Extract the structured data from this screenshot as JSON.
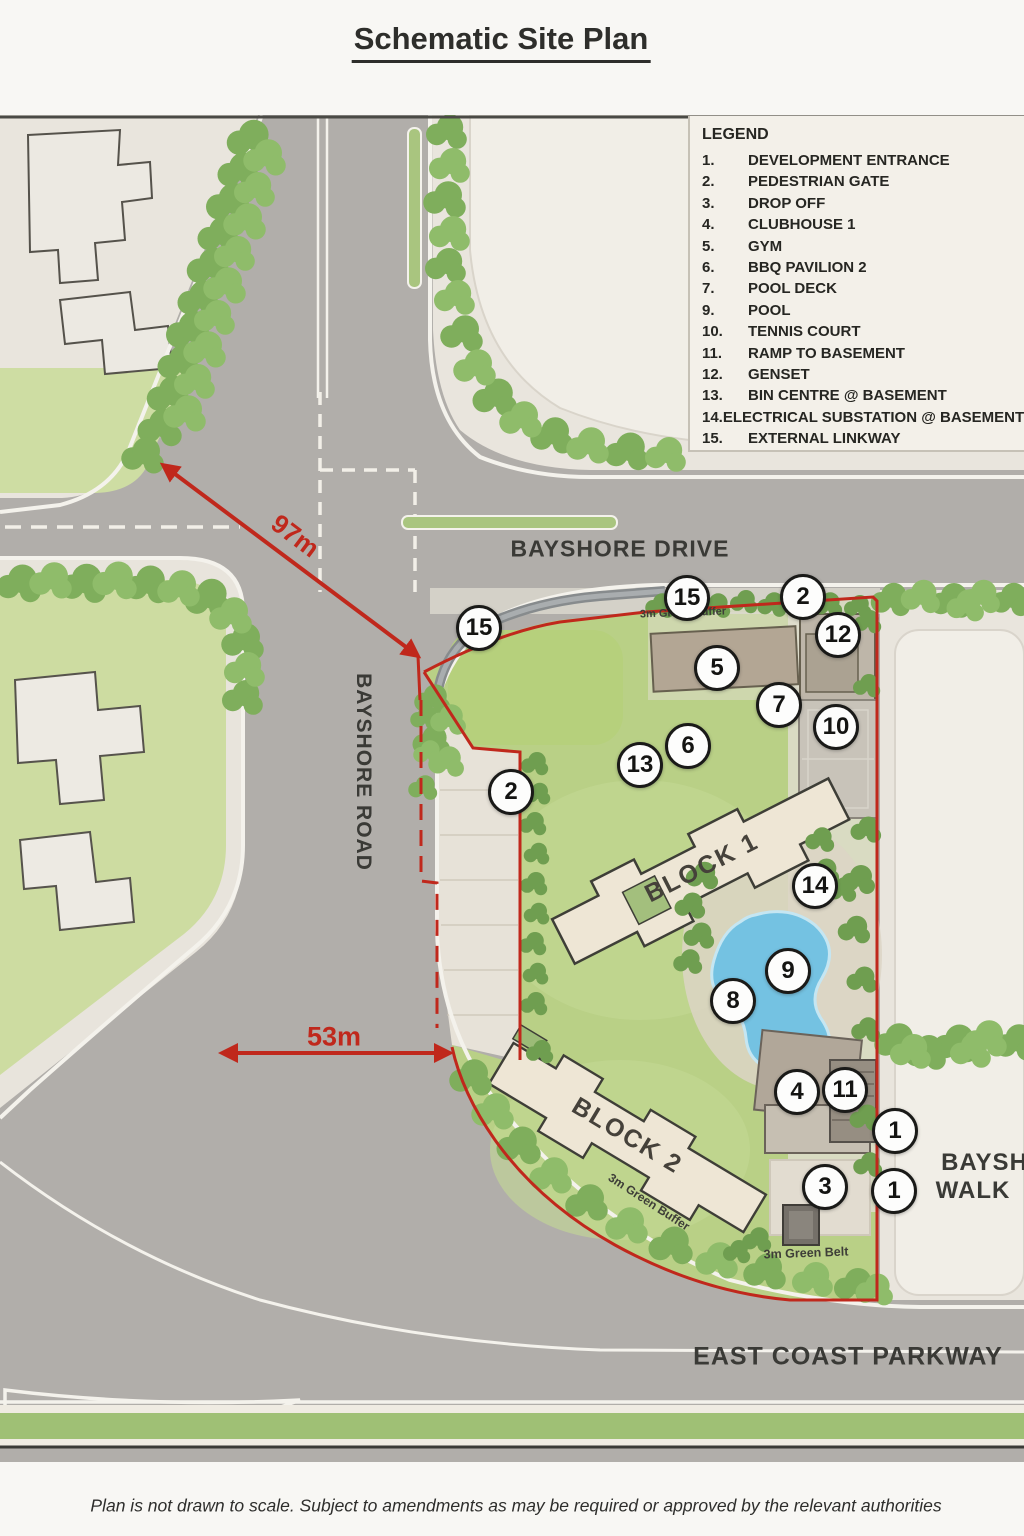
{
  "page": {
    "title": "Schematic Site Plan",
    "footer": "Plan is not drawn to scale. Subject to amendments as may be required or approved by the relevant authorities"
  },
  "legend": {
    "title": "LEGEND",
    "items": [
      {
        "num": "1.",
        "label": "DEVELOPMENT ENTRANCE"
      },
      {
        "num": "2.",
        "label": "PEDESTRIAN GATE"
      },
      {
        "num": "3.",
        "label": "DROP OFF"
      },
      {
        "num": "4.",
        "label": "CLUBHOUSE 1"
      },
      {
        "num": "5.",
        "label": "GYM"
      },
      {
        "num": "6.",
        "label": "BBQ PAVILION 2"
      },
      {
        "num": "7.",
        "label": "POOL DECK"
      },
      {
        "num": "9.",
        "label": "POOL"
      },
      {
        "num": "10.",
        "label": "TENNIS COURT"
      },
      {
        "num": "11.",
        "label": "RAMP TO BASEMENT"
      },
      {
        "num": "12.",
        "label": "GENSET"
      },
      {
        "num": "13.",
        "label": "BIN CENTRE @ BASEMENT"
      },
      {
        "num": "14.",
        "label": "ELECTRICAL SUBSTATION @ BASEMENT"
      },
      {
        "num": "15.",
        "label": "EXTERNAL LINKWAY"
      }
    ]
  },
  "roads": {
    "bayshore_drive": "BAYSHORE DRIVE",
    "bayshore_road": "BAYSHORE ROAD",
    "east_coast_parkway": "EAST COAST PARKWAY",
    "bayshore_walk_line1": "BAYSHORE",
    "bayshore_walk_line2": "WALK"
  },
  "site": {
    "block1": "BLOCK 1",
    "block2": "BLOCK 2"
  },
  "dimensions": {
    "d97": "97m",
    "d53": "53m"
  },
  "map_labels": {
    "buffers": [
      {
        "text": "3m Green Buffer",
        "x": 683,
        "y": 613,
        "rot": -2,
        "size": 11
      },
      {
        "text": "3m Green Buffer",
        "x": 649,
        "y": 1202,
        "rot": 33,
        "size": 12
      },
      {
        "text": "3m Green Belt",
        "x": 806,
        "y": 1253,
        "rot": -2,
        "size": 12.5
      }
    ]
  },
  "markers": [
    {
      "n": "15",
      "x": 479,
      "y": 628
    },
    {
      "n": "15",
      "x": 687,
      "y": 598
    },
    {
      "n": "2",
      "x": 803,
      "y": 597
    },
    {
      "n": "12",
      "x": 838,
      "y": 635
    },
    {
      "n": "5",
      "x": 717,
      "y": 668
    },
    {
      "n": "7",
      "x": 779,
      "y": 705
    },
    {
      "n": "10",
      "x": 836,
      "y": 727
    },
    {
      "n": "6",
      "x": 688,
      "y": 746
    },
    {
      "n": "13",
      "x": 640,
      "y": 765
    },
    {
      "n": "2",
      "x": 511,
      "y": 792
    },
    {
      "n": "14",
      "x": 815,
      "y": 886
    },
    {
      "n": "9",
      "x": 788,
      "y": 971
    },
    {
      "n": "8",
      "x": 733,
      "y": 1001
    },
    {
      "n": "4",
      "x": 797,
      "y": 1092
    },
    {
      "n": "11",
      "x": 845,
      "y": 1090
    },
    {
      "n": "1",
      "x": 895,
      "y": 1131
    },
    {
      "n": "3",
      "x": 825,
      "y": 1187
    },
    {
      "n": "1",
      "x": 894,
      "y": 1191
    }
  ],
  "colors": {
    "boundary_red": "#c0281c",
    "pool_blue": "#74c2e2",
    "site_lawn": "#b9d086",
    "road_gray": "#b1aeaa"
  }
}
